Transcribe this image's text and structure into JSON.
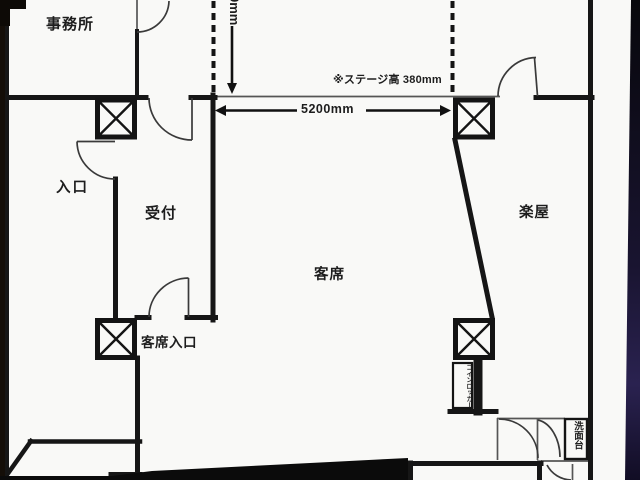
{
  "rooms": {
    "office": "事務所",
    "entrance": "入口",
    "reception": "受付",
    "audience_seating": "客席",
    "audience_entrance": "客席入口",
    "dressing_room": "楽屋"
  },
  "fixtures": {
    "coin_locker": "コインロッカー",
    "washstand": "洗面台"
  },
  "dimensions": {
    "stage_width": "5200mm",
    "stage_height_note": "※ステージ高 380mm",
    "vertical_dim_partial": "0mm"
  },
  "colors": {
    "paper": "#f9f9f7",
    "wall": "#161616",
    "thin_line": "#555555",
    "door_arc": "#3a3a3a",
    "photo_edge_left": "#140e08",
    "photo_shadow_bottom": "#0b0b0b",
    "photo_edge_right_glow": "#2a2250"
  }
}
